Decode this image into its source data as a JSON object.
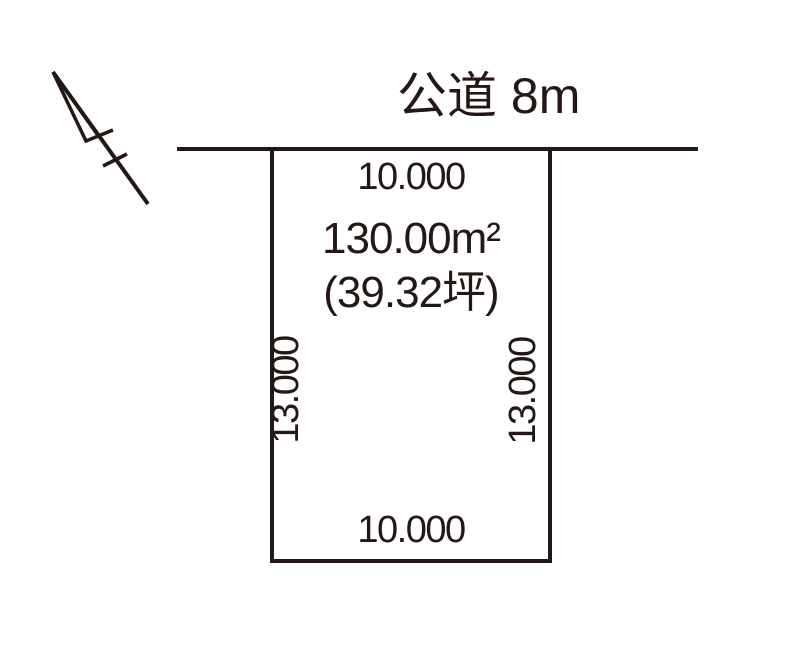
{
  "page": {
    "background_color": "#ffffff",
    "ink_color": "#231815",
    "type": "land-plot-diagram"
  },
  "road": {
    "label": "公道 8m"
  },
  "plot": {
    "area_m2": "130.00m²",
    "area_tsubo": "(39.32坪)",
    "dims": {
      "top": "10.000",
      "bottom": "10.000",
      "left": "13.000",
      "right": "13.000"
    }
  },
  "icons": {
    "north_arrow": "north-arrow-icon"
  }
}
